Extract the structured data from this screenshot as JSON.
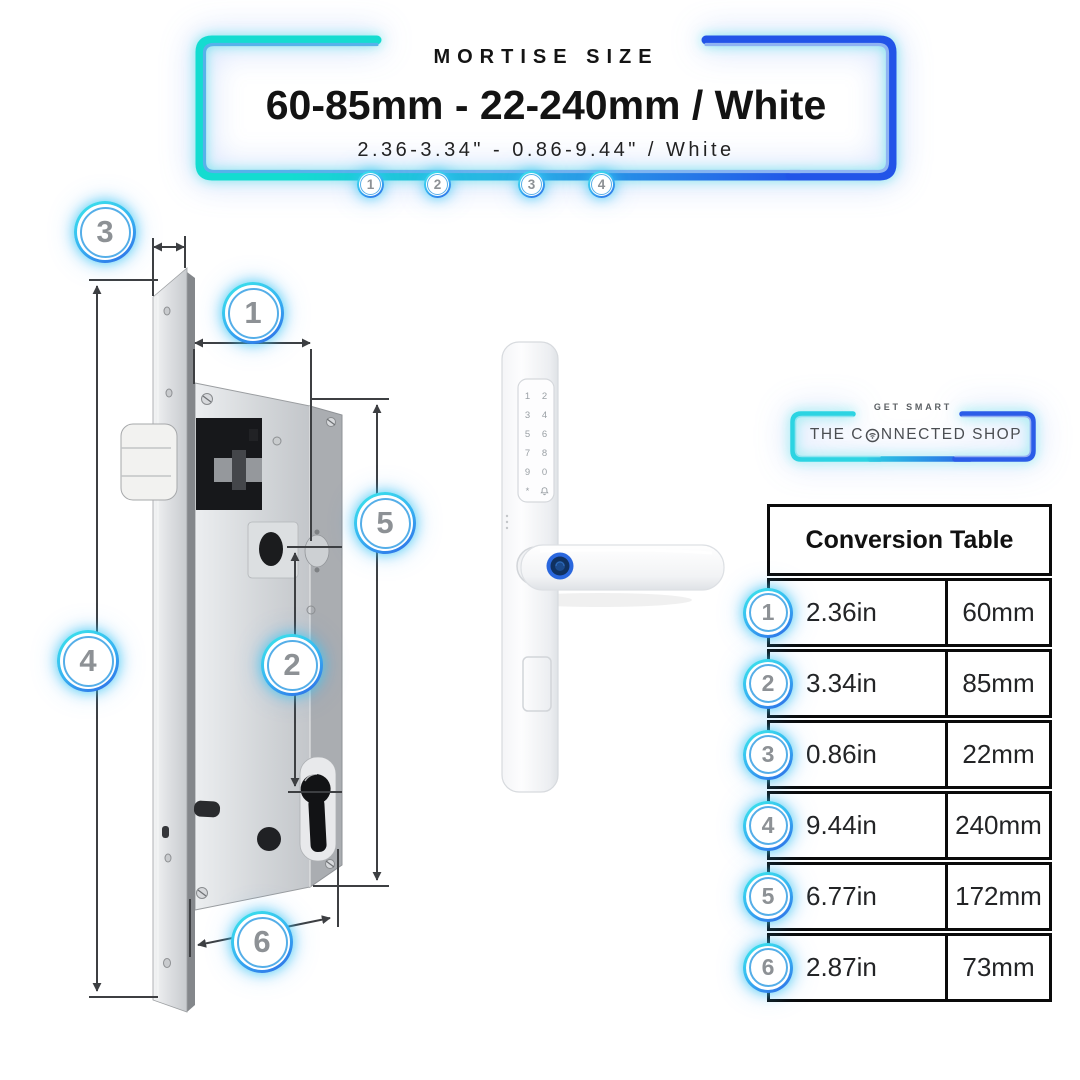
{
  "header": {
    "kicker": "MORTISE SIZE",
    "title": "60-85mm - 22-240mm / White",
    "subtitle": "2.36-3.34\" - 0.86-9.44\" / White",
    "markers": [
      "1",
      "2",
      "3",
      "4"
    ]
  },
  "diagram": {
    "callouts": {
      "c1": "1",
      "c2": "2",
      "c3": "3",
      "c4": "4",
      "c5": "5",
      "c6": "6"
    }
  },
  "handle": {
    "keypad_keys": [
      "1",
      "2",
      "3",
      "4",
      "5",
      "6",
      "7",
      "8",
      "9",
      "0",
      "*"
    ],
    "icons": {
      "bell": "doorbell-icon",
      "fingerprint": "fingerprint-sensor"
    }
  },
  "brand": {
    "tagline": "GET SMART",
    "name_prefix": "THE C",
    "name_suffix": "NNECTED SHOP",
    "wifi_icon": "wifi-icon"
  },
  "conversion_table": {
    "title": "Conversion Table",
    "rows": [
      {
        "num": "1",
        "inches": "2.36in",
        "mm": "60mm"
      },
      {
        "num": "2",
        "inches": "3.34in",
        "mm": "85mm"
      },
      {
        "num": "3",
        "inches": "0.86in",
        "mm": "22mm"
      },
      {
        "num": "4",
        "inches": "9.44in",
        "mm": "240mm"
      },
      {
        "num": "5",
        "inches": "6.77in",
        "mm": "172mm"
      },
      {
        "num": "6",
        "inches": "2.87in",
        "mm": "73mm"
      }
    ]
  },
  "colors": {
    "neon_cyan": "#14dcd0",
    "neon_blue": "#2254e8",
    "badge_number_gray": "#8d9195",
    "text_dark": "#131313",
    "fingerprint_blue": "#2a67de"
  }
}
